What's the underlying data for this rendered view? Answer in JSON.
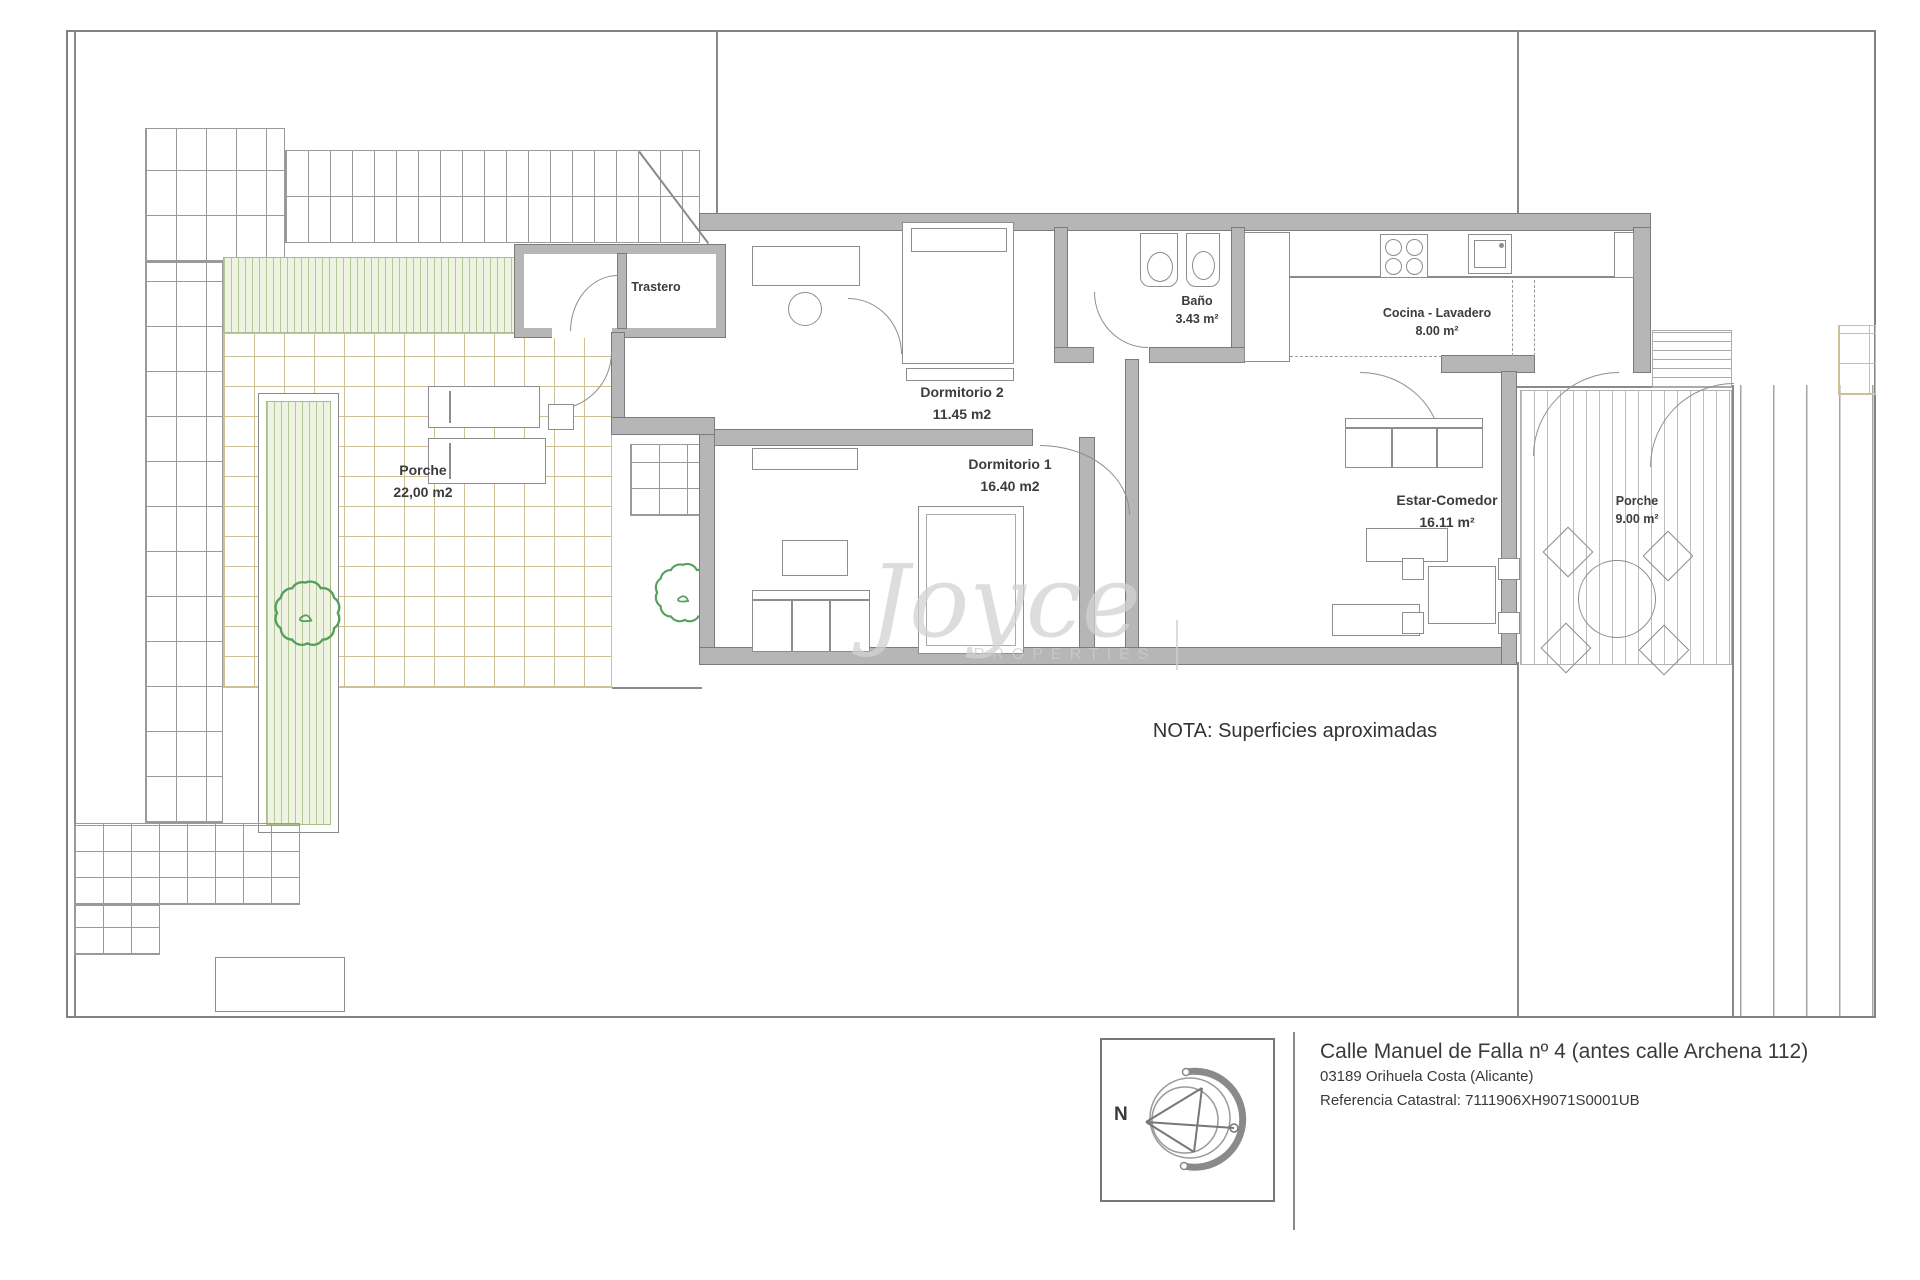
{
  "plan": {
    "rooms": [
      {
        "name": "Trastero",
        "area": ""
      },
      {
        "name": "Dormitorio 2",
        "area": "11.45 m2"
      },
      {
        "name": "Baño",
        "area": "3.43 m²"
      },
      {
        "name": "Cocina - Lavadero",
        "area": "8.00 m²"
      },
      {
        "name": "Porche",
        "area": "22,00 m2"
      },
      {
        "name": "Dormitorio 1",
        "area": "16.40 m2"
      },
      {
        "name": "Estar-Comedor",
        "area": "16.11 m²"
      },
      {
        "name": "Porche",
        "area": "9.00 m²"
      }
    ],
    "note": "NOTA: Superficies aproximadas"
  },
  "watermark": {
    "script": "Joyce",
    "caps": "PROPERTIES"
  },
  "footer": {
    "compass_label": "N",
    "address_line1": "Calle Manuel de Falla nº 4 (antes calle Archena 112)",
    "address_line2": "03189 Orihuela Costa (Alicante)",
    "address_line3": "Referencia Catastral: 7111906XH9071S0001UB"
  },
  "colors": {
    "wall_gray": "#b6b6b6",
    "tile_tan": "#cfc196",
    "stripe_green": "#b6c897",
    "tree_green": "#55a05a",
    "line_gray": "#8a8a8a"
  }
}
